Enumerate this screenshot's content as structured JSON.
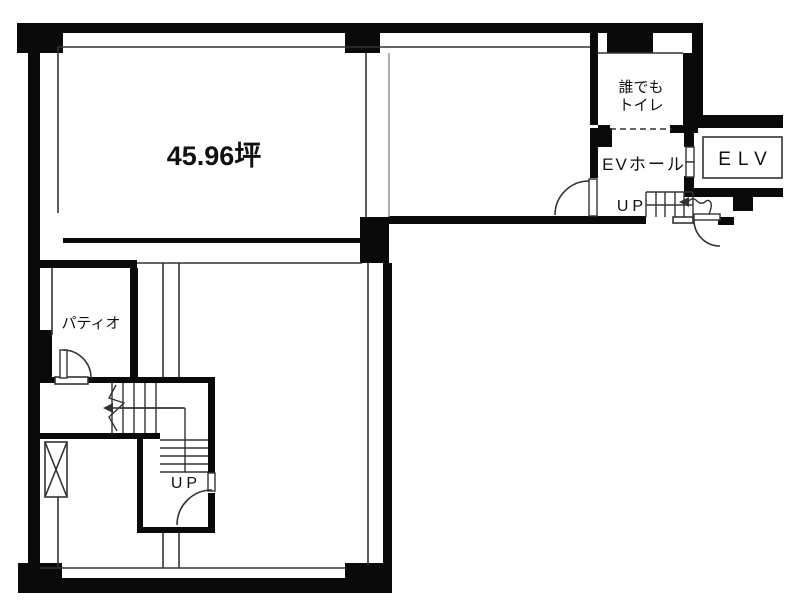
{
  "plan": {
    "type": "building-floor-plan",
    "area_label": "45.96坪",
    "rooms": {
      "accessible_toilet_line1": "誰でも",
      "accessible_toilet_line2": "トイレ",
      "ev_hall": "EVホール",
      "elevator": "ELV",
      "patio": "パティオ"
    },
    "stairs": {
      "up_near_elevator": "UP",
      "up_main": "UP"
    }
  },
  "colors": {
    "wall": "#0a0a0a",
    "line": "#333333",
    "line_light": "#8a8a8a",
    "bg": "#ffffff",
    "text": "#111111"
  }
}
